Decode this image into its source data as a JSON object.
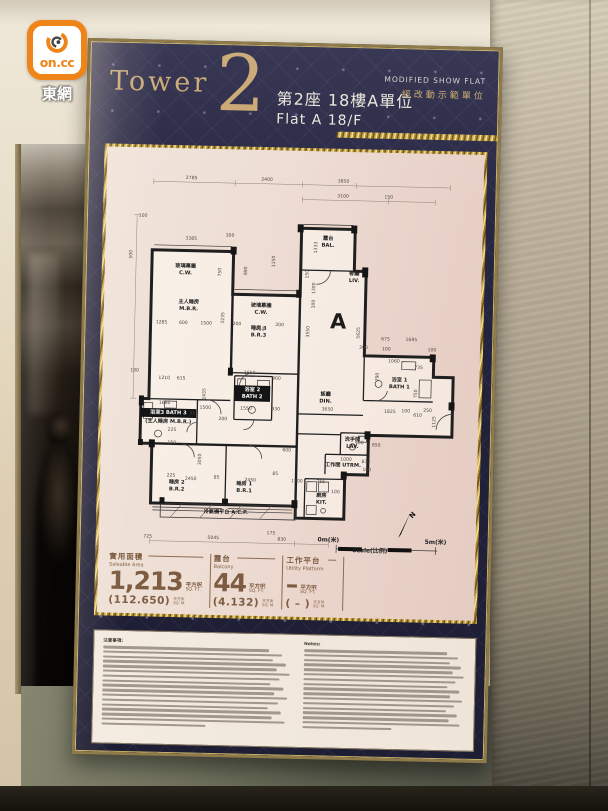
{
  "logo": {
    "text": "on.cc",
    "site": "東網"
  },
  "poster": {
    "tower_label": "Tower",
    "tower_number": "2",
    "subtitle_zh": "第2座 18樓A單位",
    "subtitle_en": "Flat A 18/F",
    "flag_en": "MODIFIED SHOW FLAT",
    "flag_zh": "經改動示範單位"
  },
  "floorplan": {
    "unit_letter": "A",
    "north_label": "N",
    "scale": {
      "left": "0m(米)",
      "right": "5m(米)",
      "caption": "Scale(比例)"
    },
    "rooms": [
      {
        "lines": [
          "玻璃幕牆",
          "C.W."
        ],
        "x": 80,
        "y": 120
      },
      {
        "lines": [
          "主人睡房",
          "M.B.R."
        ],
        "x": 84,
        "y": 156
      },
      {
        "lines": [
          "玻璃幕牆",
          "C.W."
        ],
        "x": 157,
        "y": 158
      },
      {
        "lines": [
          "睡房 3",
          "B.R.3"
        ],
        "x": 155,
        "y": 181
      },
      {
        "lines": [
          "露台",
          "BAL."
        ],
        "x": 223,
        "y": 89
      },
      {
        "lines": [
          "客廳",
          "LIV."
        ],
        "x": 250,
        "y": 124
      },
      {
        "lines": [
          "飯廳",
          "DIN."
        ],
        "x": 224,
        "y": 246
      },
      {
        "lines": [
          "浴室 1",
          "BATH 1"
        ],
        "x": 298,
        "y": 230
      },
      {
        "lines": [
          "浴室3 BATH 3"
        ],
        "x": 66,
        "y": 268,
        "dark": true
      },
      {
        "lines": [
          "(主人睡房 M.B.R.)"
        ],
        "x": 66,
        "y": 277
      },
      {
        "lines": [
          "浴室 2",
          "BATH 2"
        ],
        "x": 150,
        "y": 243,
        "dark": true
      },
      {
        "lines": [
          "洗手間",
          "LAV."
        ],
        "x": 252,
        "y": 291
      },
      {
        "lines": [
          "工作間 UTRM."
        ],
        "x": 243,
        "y": 317
      },
      {
        "lines": [
          "廚房",
          "KIT."
        ],
        "x": 222,
        "y": 348
      },
      {
        "lines": [
          "睡房 2",
          "B.R.2"
        ],
        "x": 76,
        "y": 338
      },
      {
        "lines": [
          "睡房 1",
          "B.R.1"
        ],
        "x": 144,
        "y": 338
      },
      {
        "lines": [
          "冷氣機平台 A.C.P."
        ],
        "x": 126,
        "y": 367
      }
    ],
    "dims": [
      [
        "2785",
        84,
        31
      ],
      [
        "2400",
        160,
        31
      ],
      [
        "3850",
        237,
        31
      ],
      [
        "3100",
        237,
        46
      ],
      [
        "150",
        283,
        46
      ],
      [
        "100",
        36,
        70
      ],
      [
        "3385",
        85,
        92
      ],
      [
        "300",
        124,
        88
      ],
      [
        "500",
        26,
        108,
        -90
      ],
      [
        "750",
        116,
        124,
        -90
      ],
      [
        "890",
        142,
        122,
        -90
      ],
      [
        "1150",
        170,
        112,
        -90
      ],
      [
        "1285",
        57,
        177
      ],
      [
        "600",
        79,
        177
      ],
      [
        "1500",
        102,
        177
      ],
      [
        "3235",
        120,
        170,
        -90
      ],
      [
        "200",
        133,
        177
      ],
      [
        "2450",
        155,
        182
      ],
      [
        "200",
        176,
        177
      ],
      [
        "1333",
        212,
        97,
        -90
      ],
      [
        "150",
        204,
        124,
        -90
      ],
      [
        "1300",
        211,
        138,
        -90
      ],
      [
        "300",
        211,
        154,
        -90
      ],
      [
        "3550",
        206,
        182,
        -90
      ],
      [
        "5625",
        257,
        182,
        -90
      ],
      [
        "675",
        283,
        189
      ],
      [
        "1695",
        309,
        189
      ],
      [
        "100",
        284,
        199
      ],
      [
        "100",
        330,
        199
      ],
      [
        "200",
        261,
        198
      ],
      [
        "1060",
        292,
        211
      ],
      [
        "735",
        317,
        217
      ],
      [
        "790",
        277,
        226,
        -90
      ],
      [
        "750",
        316,
        242,
        -90
      ],
      [
        "3650",
        226,
        261
      ],
      [
        "1825",
        289,
        262
      ],
      [
        "100",
        305,
        261
      ],
      [
        "610",
        317,
        265
      ],
      [
        "250",
        327,
        260
      ],
      [
        "1125",
        335,
        270,
        -90
      ],
      [
        "180",
        31,
        226
      ],
      [
        "1210",
        61,
        233
      ],
      [
        "615",
        78,
        233
      ],
      [
        "1660",
        62,
        258
      ],
      [
        "1550",
        147,
        226
      ],
      [
        "900",
        174,
        231
      ],
      [
        "2435",
        103,
        247,
        -90
      ],
      [
        "1500",
        103,
        262
      ],
      [
        "1550",
        144,
        262
      ],
      [
        "930",
        174,
        262
      ],
      [
        "200",
        121,
        273
      ],
      [
        "35",
        90,
        268
      ],
      [
        "225",
        70,
        285
      ],
      [
        "150",
        70,
        298
      ],
      [
        "3050",
        100,
        313,
        -90
      ],
      [
        "225",
        70,
        331
      ],
      [
        "2450",
        90,
        334
      ],
      [
        "85",
        116,
        332
      ],
      [
        "2450",
        150,
        334
      ],
      [
        "85",
        175,
        327
      ],
      [
        "600",
        186,
        303
      ],
      [
        "400",
        259,
        294
      ],
      [
        "850",
        276,
        296
      ],
      [
        "1000",
        246,
        311
      ],
      [
        "838",
        266,
        313
      ],
      [
        "100",
        267,
        321
      ],
      [
        "1500",
        197,
        334
      ],
      [
        "715",
        221,
        334
      ],
      [
        "100",
        236,
        344
      ],
      [
        "725",
        48,
        393
      ],
      [
        "5045",
        114,
        393
      ],
      [
        "175",
        172,
        387
      ],
      [
        "830",
        183,
        393
      ]
    ]
  },
  "stats": {
    "columns": [
      {
        "title_zh": "實用面積",
        "title_en": "Saleable Area",
        "value": "1,213",
        "unit_zh": "平方呎",
        "unit_en": "SQ. FT.",
        "metric": "(112.650)",
        "metric_zh": "平方米",
        "metric_en": "SQ. M."
      },
      {
        "title_zh": "露台",
        "title_en": "Balcony",
        "value": "44",
        "unit_zh": "平方呎",
        "unit_en": "SQ. FT.",
        "metric": "(4.132)",
        "metric_zh": "平方米",
        "metric_en": "SQ. M."
      },
      {
        "title_zh": "工作平台",
        "title_en": "Utility Platform",
        "value": "–",
        "unit_zh": "平方呎",
        "unit_en": "SQ. FT.",
        "metric": "( – )",
        "metric_zh": "平方米",
        "metric_en": "SQ. M."
      }
    ]
  },
  "notes": {
    "heading_zh": "注意事項:",
    "heading_en": "Notes:"
  }
}
